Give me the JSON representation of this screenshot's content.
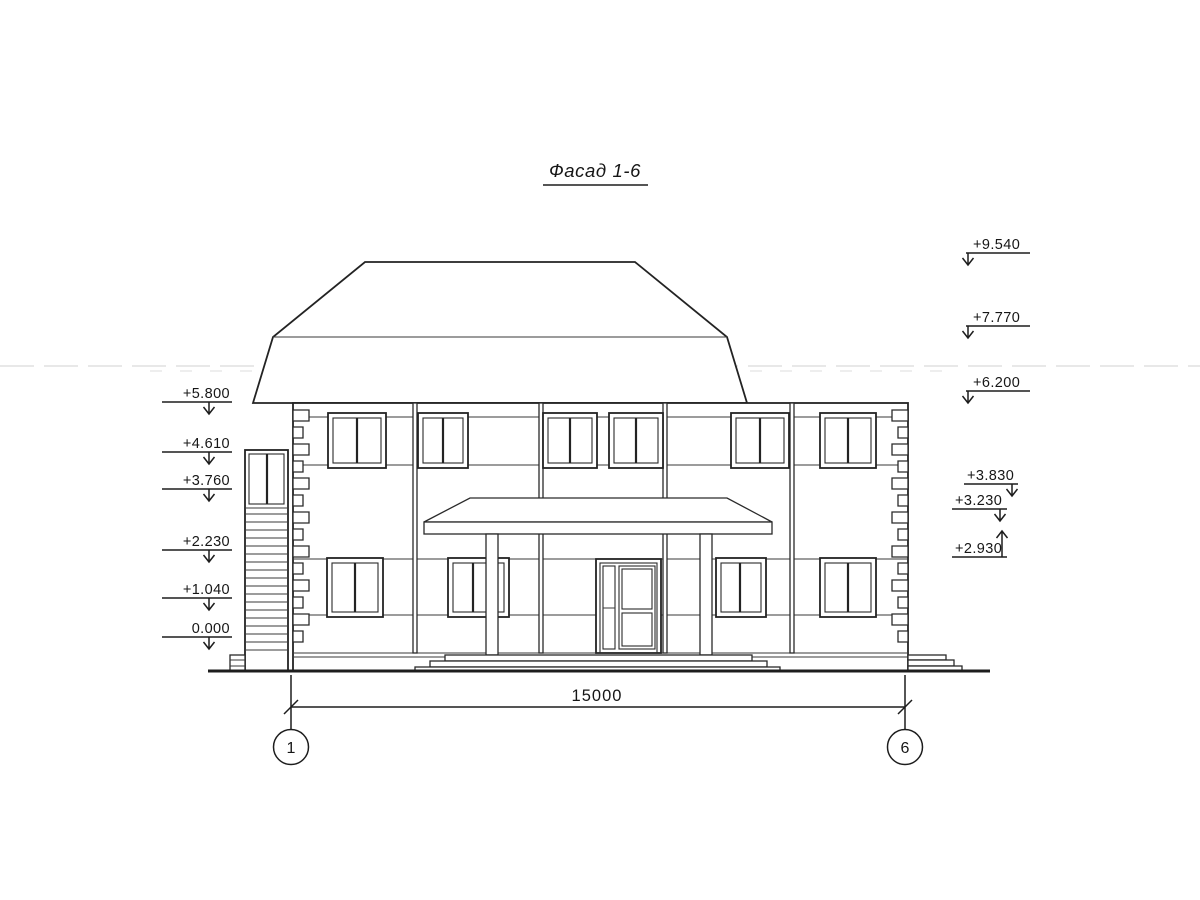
{
  "drawing": {
    "title": "Фасад 1-6",
    "dimension_label": "15000",
    "axis_left": "1",
    "axis_right": "6",
    "elevation_marks_left": [
      "+5.800",
      "+4.610",
      "+3.760",
      "+2.230",
      "+1.040",
      "0.000"
    ],
    "elevation_marks_right_upper": [
      "+9.540",
      "+7.770",
      "+6.200"
    ],
    "elevation_marks_right_lower": [
      "+3.830",
      "+3.230",
      "+2.930"
    ],
    "line_color": "#2a2a2a",
    "paper_color": "#ffffff"
  }
}
